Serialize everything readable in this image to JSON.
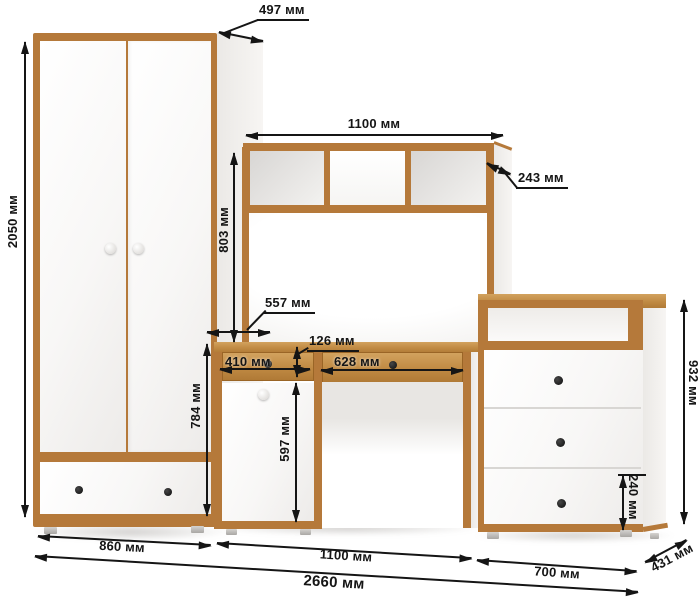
{
  "unit": "мм",
  "labels": {
    "wardrobe_height": "2050 мм",
    "wardrobe_depth": "497 мм",
    "wardrobe_width": "860 мм",
    "hutch_width": "1100 мм",
    "hutch_depth": "243 мм",
    "hutch_height": "803 мм",
    "desk_surface_depth": "557 мм",
    "desk_drawer_height": "126 мм",
    "desk_drawer_left_width": "410 мм",
    "desk_drawer_right_width": "628 мм",
    "desk_door_height": "597 мм",
    "desk_height": "784 мм",
    "desk_width": "1100 мм",
    "chest_height": "932 мм",
    "chest_drawer_height": "240 мм",
    "chest_width": "700 мм",
    "chest_depth": "431 мм",
    "total_width": "2660 мм"
  },
  "dimensions_mm": {
    "wardrobe": {
      "height": 2050,
      "width": 860,
      "depth": 497
    },
    "hutch": {
      "width": 1100,
      "depth": 243,
      "height": 803
    },
    "desk": {
      "width": 1100,
      "height": 784,
      "surface_depth": 557,
      "drawer_height": 126,
      "left_drawer_width": 410,
      "right_drawer_width": 628,
      "door_height": 597
    },
    "chest": {
      "height": 932,
      "width": 700,
      "depth": 431,
      "bottom_drawer_height": 240
    },
    "total_width": 2660
  },
  "colors": {
    "wood_trim": "#b5793a",
    "wood_face": "#c08a43",
    "panel_white": "#fbfafa",
    "dimension_line": "#151515",
    "knob_black": "#1a1a1a",
    "background": "#ffffff"
  }
}
